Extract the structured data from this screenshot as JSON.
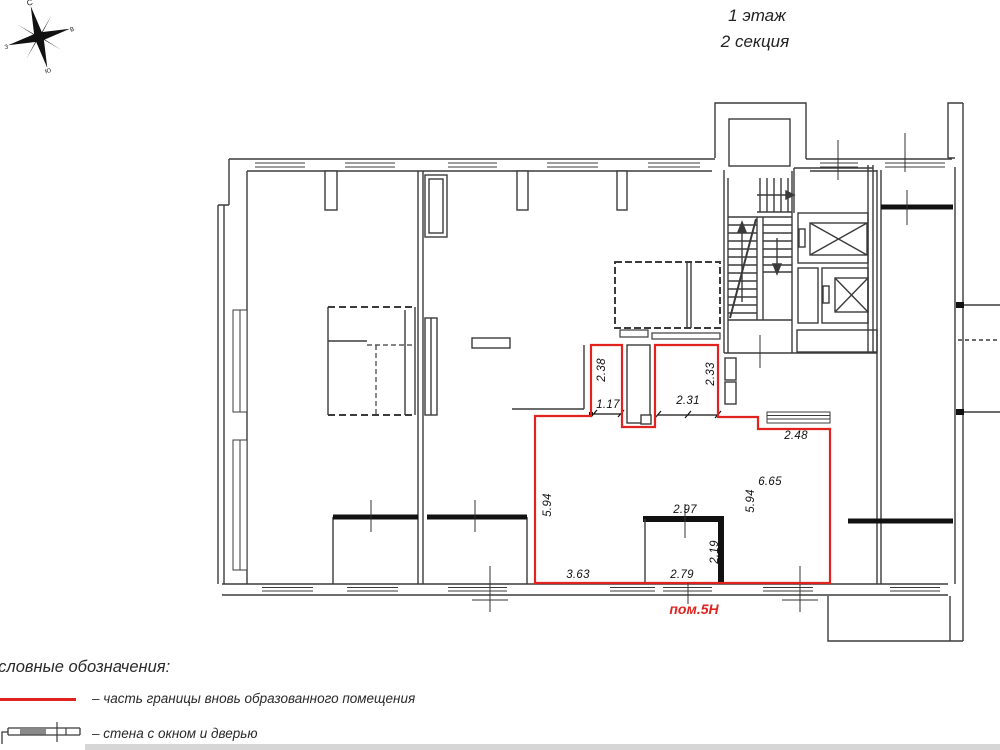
{
  "title": {
    "floor": "1 этаж",
    "section": "2 секция"
  },
  "compass": {
    "n": "С",
    "e": "В",
    "s": "Ю",
    "w": "З"
  },
  "plan": {
    "room_label": "пом.5Н",
    "dimensions": {
      "shaft_height": "2.38",
      "opening_width": "1.17",
      "hall_opening": "2.31",
      "right_shaft_height": "2.33",
      "top_right_width": "2.48",
      "left_height": "5.94",
      "room_width": "6.65",
      "room_height": "5.94",
      "inner_wall_width": "2.97",
      "inner_wall_height": "2.19",
      "bottom_left_width": "3.63",
      "bottom_center_width": "2.79"
    }
  },
  "legend": {
    "heading": "Условные обозначения:",
    "items": [
      {
        "symbol": "red-boundary-line",
        "label": "– часть границы вновь образованного помещения"
      },
      {
        "symbol": "wall-window-door",
        "label": "– стена с окном и дверью"
      }
    ]
  },
  "colors": {
    "boundary_red": "#e0231f",
    "line": "#3b3b3b",
    "wall": "#111111"
  }
}
